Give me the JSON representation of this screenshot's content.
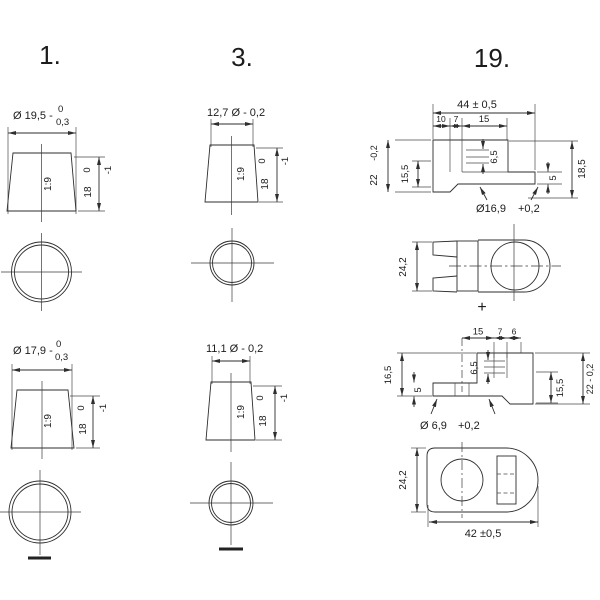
{
  "meta": {
    "ink": "#2e2e2e",
    "background": "#ffffff"
  },
  "s1": {
    "label": "1.",
    "top": {
      "dia": "Ø 19,5 -",
      "tolUp": "0",
      "tolDn": "0,3",
      "taper": "1:9",
      "h": "18",
      "hUp": "0",
      "hDn": "-1"
    },
    "bot": {
      "dia": "Ø 17,9 -",
      "tolUp": "0",
      "tolDn": "0,3",
      "taper": "1:9",
      "h": "18",
      "hUp": "0",
      "hDn": "-1"
    },
    "polarity": "minus"
  },
  "s3": {
    "label": "3.",
    "top": {
      "dia": "12,7 Ø - 0,2",
      "taper": "1:9",
      "h": "18",
      "hUp": "0",
      "hDn": "-1"
    },
    "bot": {
      "dia": "11,1 Ø - 0,2",
      "taper": "1:9",
      "h": "18",
      "hUp": "0",
      "hDn": "-1"
    },
    "polarity": "minus"
  },
  "s19": {
    "label": "19.",
    "sideTop": {
      "w": "44 ± 0,5",
      "a": "10",
      "b": "7",
      "c": "15",
      "h": "22",
      "hTol": "-0,2",
      "ih": "15,5",
      "slot": "6,5",
      "rh": "18,5",
      "blade": "5",
      "hole": "Ø16,9",
      "holeTol": "+0,2"
    },
    "planTop": {
      "h": "24,2",
      "plus": "+"
    },
    "sideBot": {
      "a": "15",
      "b": "7",
      "c": "6",
      "lh": "16,5",
      "blade": "5",
      "slot": "6,5",
      "ih": "15,5",
      "h": "22 - 0,2",
      "hole": "Ø 6,9",
      "holeTol": "+0,2"
    },
    "planBot": {
      "h": "24,2",
      "w": "42 ±0,5"
    }
  }
}
